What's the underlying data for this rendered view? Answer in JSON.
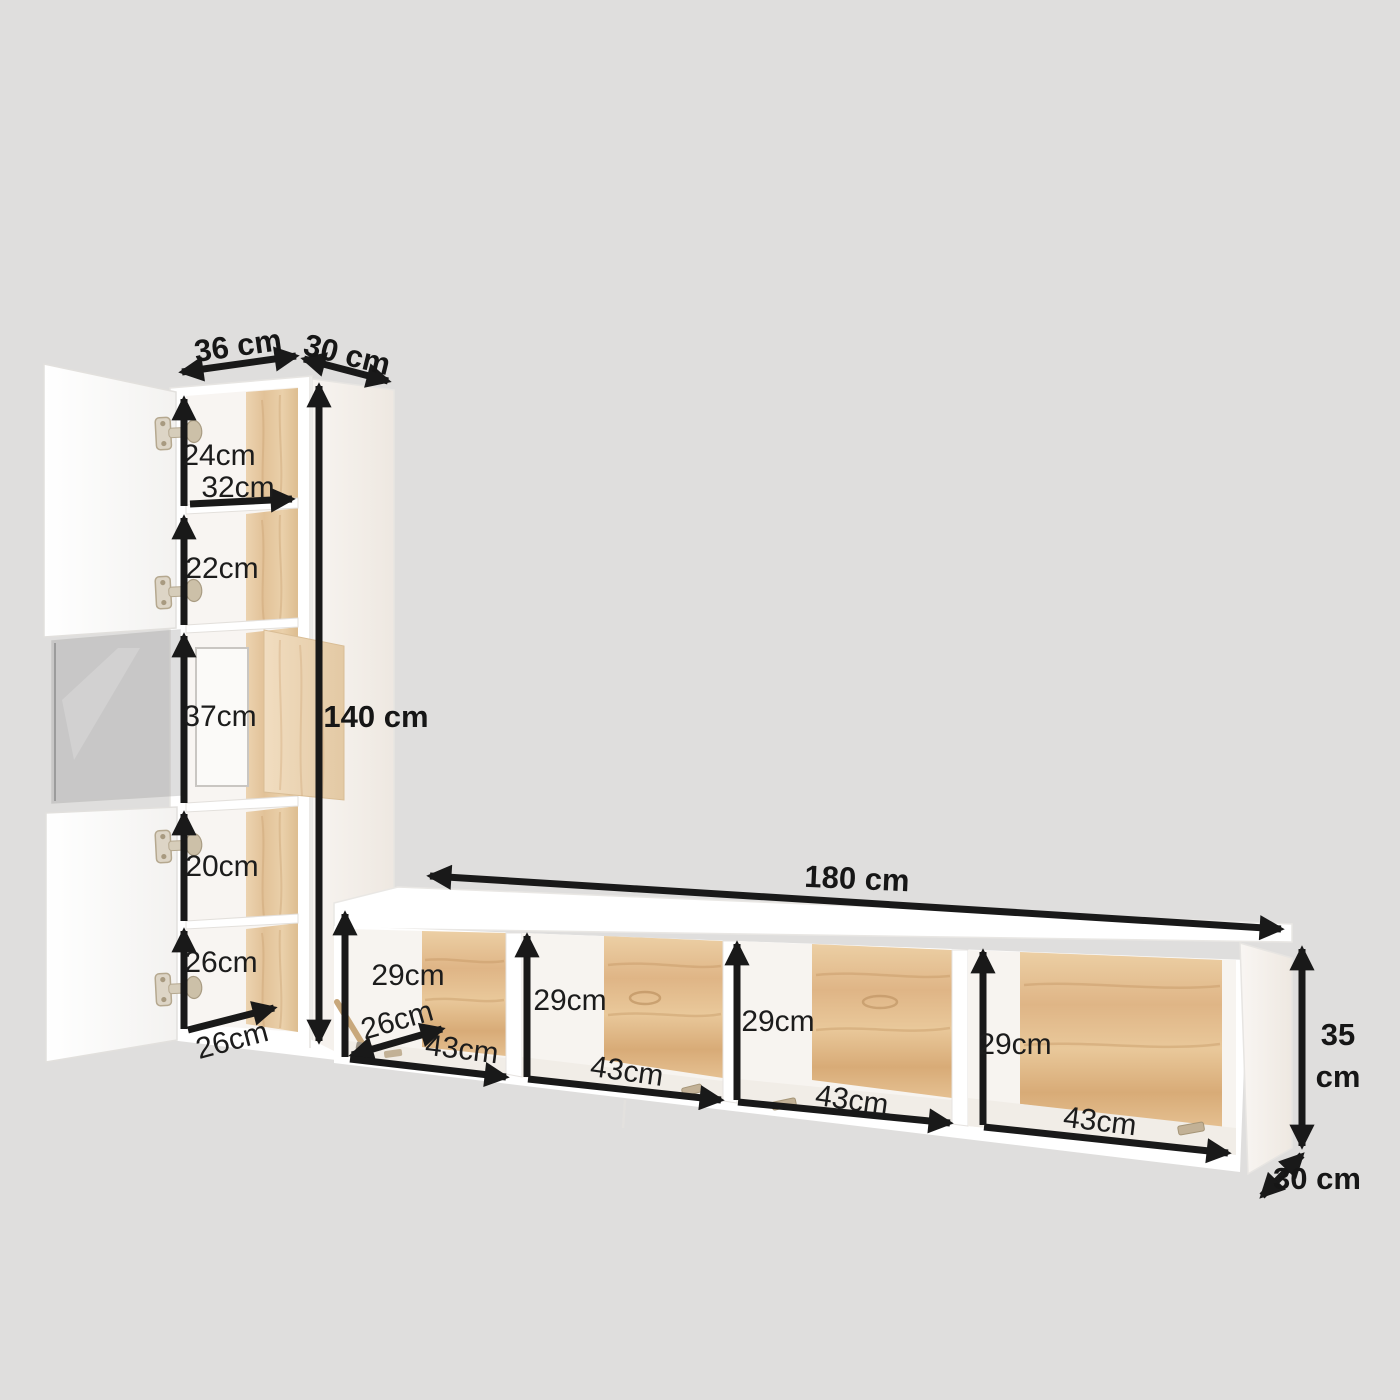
{
  "diagram_title": "wall-unit furniture dimension diagram",
  "cabinet": {
    "top_width_label": "36 cm",
    "top_depth_label": "30 cm",
    "height_label": "140 cm",
    "inner_width_label": "32cm",
    "bottom_depth_label": "26cm",
    "compartment_heights": [
      "24cm",
      "22cm",
      "37cm",
      "20cm",
      "26cm"
    ]
  },
  "tv_stand": {
    "width_label": "180 cm",
    "height_label_lines": [
      "35",
      "cm"
    ],
    "depth_label": "30 cm",
    "inner_depth_label": "26cm",
    "compartments": [
      {
        "height_label": "29cm",
        "width_label": "43cm"
      },
      {
        "height_label": "29cm",
        "width_label": "43cm"
      },
      {
        "height_label": "29cm",
        "width_label": "43cm"
      },
      {
        "height_label": "29cm",
        "width_label": "43cm"
      }
    ]
  },
  "palette": {
    "background": "#dfdedd",
    "furniture_white": "#ffffff",
    "wood_oak": "#e0b27f",
    "wood_oak_light": "#e9d0ab",
    "arrow_black": "#191919",
    "hinge_tan": "#cfc3ae",
    "glass_gray": "#9a9a9a"
  }
}
